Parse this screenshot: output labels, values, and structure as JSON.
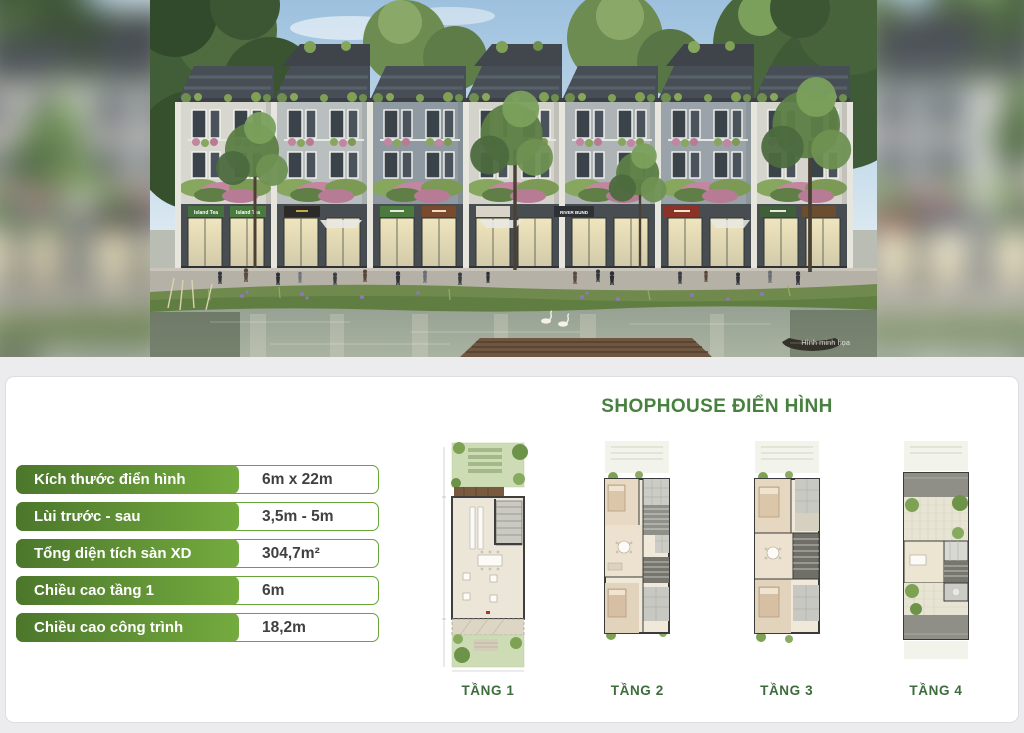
{
  "photo": {
    "watermark": "Hình minh họa",
    "signs": {
      "s1": "Island Tea",
      "s2": "Island Tea",
      "s3": "RIVER BUND"
    }
  },
  "panel": {
    "title": "SHOPHOUSE ĐIỂN HÌNH",
    "specs": [
      {
        "label": "Kích thước điển hình",
        "value": "6m x 22m"
      },
      {
        "label": "Lùi trước - sau",
        "value": "3,5m - 5m"
      },
      {
        "label": "Tổng diện tích sàn XD",
        "value": "304,7m²"
      },
      {
        "label": "Chiều cao tầng 1",
        "value": "6m"
      },
      {
        "label": "Chiều cao công trình",
        "value": "18,2m"
      }
    ],
    "floor_plans": [
      {
        "label": "TẦNG 1"
      },
      {
        "label": "TẦNG 2"
      },
      {
        "label": "TẦNG 3"
      },
      {
        "label": "TẦNG 4"
      }
    ]
  },
  "colors": {
    "accent_green_dark": "#4c772c",
    "accent_green_light": "#74ab3e",
    "value_border_green": "#67a437",
    "title_green": "#47813f",
    "floor_label_green": "#3d6d3b"
  }
}
